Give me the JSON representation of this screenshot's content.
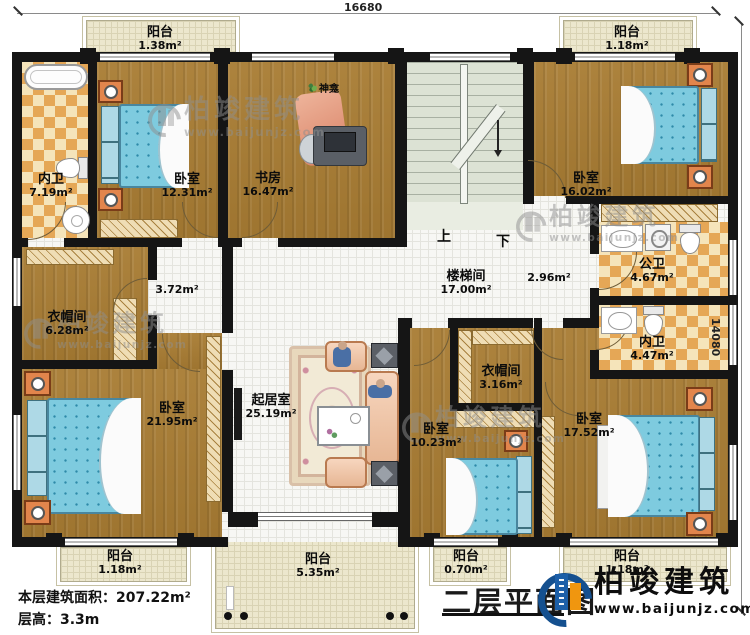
{
  "title": {
    "text": "二层平面图"
  },
  "footer": {
    "area": "本层建筑面积：207.22m²",
    "height": "层高：3.3m"
  },
  "dimensions": {
    "width_label": "16680",
    "height_label": "14080"
  },
  "logo": {
    "brand": "柏竣建筑",
    "url": "www.baijunjz.com"
  },
  "watermark": {
    "brand": "柏竣建筑",
    "url": "www.baijunjz.com"
  },
  "stairs": {
    "up": "上",
    "down": "下"
  },
  "shrine": {
    "label": "神龛"
  },
  "corridors": [
    {
      "area": "3.72m²"
    },
    {
      "area": "2.96m²"
    }
  ],
  "rooms": [
    {
      "name": "阳台",
      "area": "1.38m²"
    },
    {
      "name": "阳台",
      "area": "1.18m²"
    },
    {
      "name": "内卫",
      "area": "7.19m²"
    },
    {
      "name": "卧室",
      "area": "12.31m²"
    },
    {
      "name": "书房",
      "area": "16.47m²"
    },
    {
      "name": "卧室",
      "area": "16.02m²"
    },
    {
      "name": "楼梯间",
      "area": "17.00m²"
    },
    {
      "name": "公卫",
      "area": "4.67m²"
    },
    {
      "name": "内卫",
      "area": "4.47m²"
    },
    {
      "name": "衣帽间",
      "area": "6.28m²"
    },
    {
      "name": "卧室",
      "area": "21.95m²"
    },
    {
      "name": "起居室",
      "area": "25.19m²"
    },
    {
      "name": "衣帽间",
      "area": "3.16m²"
    },
    {
      "name": "卧室",
      "area": "10.23m²"
    },
    {
      "name": "卧室",
      "area": "17.52m²"
    },
    {
      "name": "阳台",
      "area": "1.18m²"
    },
    {
      "name": "阳台",
      "area": "5.35m²"
    },
    {
      "name": "阳台",
      "area": "0.70m²"
    },
    {
      "name": "阳台",
      "area": "1.18m²"
    }
  ],
  "colors": {
    "wall": "#151515",
    "wood_floor": "#a87c33",
    "tile_light": "#f2dfb2",
    "tile_dark": "#e5a756",
    "corridor_floor": "#f7f7f4",
    "balcony_floor": "#ece7cd",
    "stair_floor": "#dce2d4",
    "bed": "#7ecbdf",
    "nightstand": "#e2854c",
    "sofa": "#f3c09c",
    "logo_blue": "#1c5fa8",
    "logo_orange": "#f0960f"
  }
}
